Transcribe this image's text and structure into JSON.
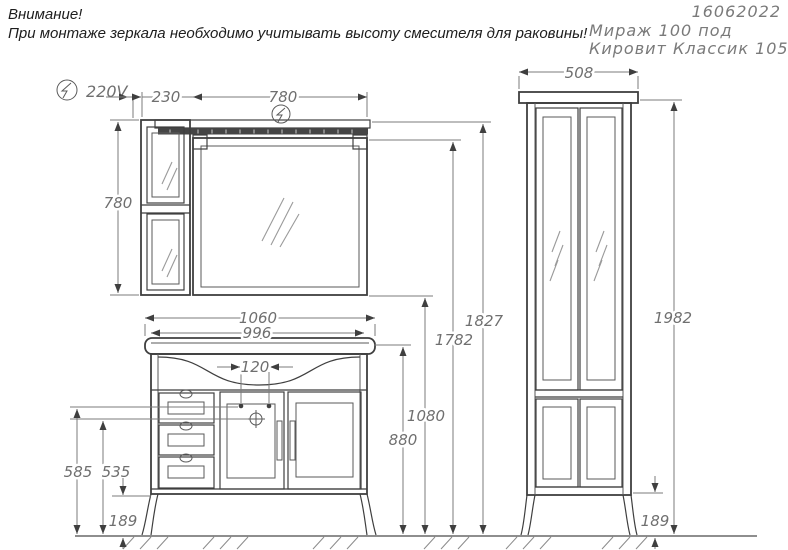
{
  "labels": {
    "warning_title": "Внимание!",
    "warning_text": "При монтаже зеркала необходимо учитывать высоту смесителя для раковины!",
    "doc_number": "16062022",
    "model_line1": "Мираж 100 под",
    "model_line2": "Кировит Классик 105",
    "voltage": "220V"
  },
  "dims": {
    "side_cabinet_width": "230",
    "mirror_width": "780",
    "mirror_height": "780",
    "basin_width": "1060",
    "body_width": "996",
    "faucet_spacing": "120",
    "drawer_line_height": "585",
    "siphon_height": "535",
    "leg_height_left": "189",
    "basin_top_height": "880",
    "mirror_bottom_height": "1080",
    "mirror_top_height": "1782",
    "total_height": "1827",
    "column_width": "508",
    "column_height": "1982",
    "leg_height_right": "189"
  },
  "icons": {
    "power_symbol": "lightning-bolt"
  },
  "colors": {
    "structure_line": "#3f3f3f",
    "dimension_line": "#7b7b7b",
    "dimension_text": "#6f6f6f",
    "title_text": "#7a7a7a",
    "lamp_fill": "#454545",
    "background": "#ffffff"
  }
}
